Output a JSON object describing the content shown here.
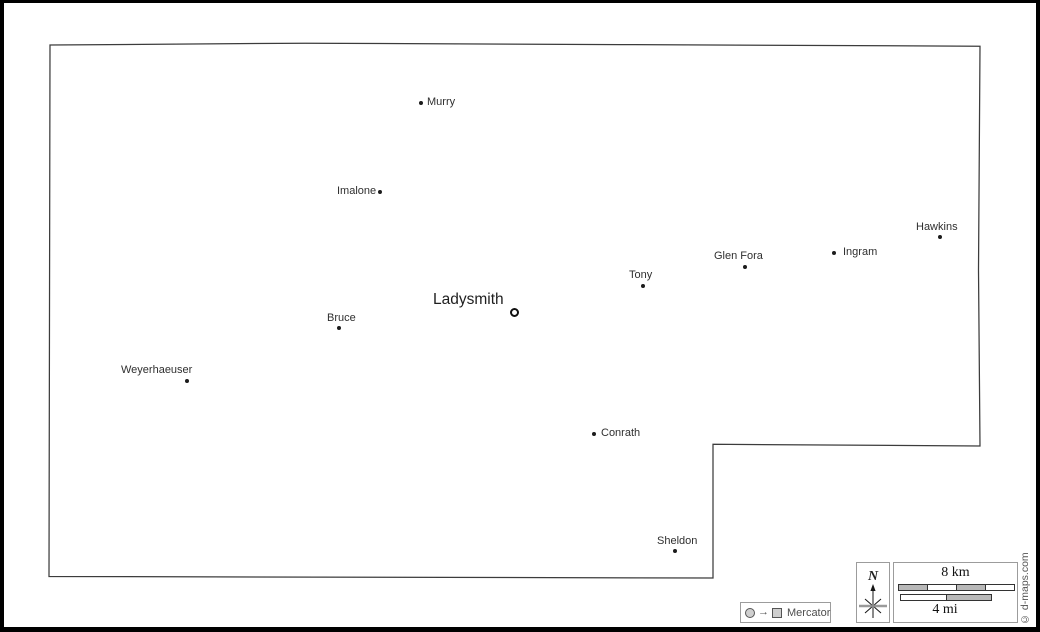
{
  "map": {
    "region_outline_name": "county-boundary",
    "outline_points_str": "50,45 305,43.2 620,44.6 980,46.2 978.5,270 980,446 713,444.3 713,578 49,576.5",
    "county_seat_name": "Ladysmith",
    "towns": [
      {
        "name": "Ladysmith",
        "marker": "ring",
        "dot": {
          "x": 514,
          "y": 312
        },
        "label": {
          "x": 433,
          "y": 291
        }
      },
      {
        "name": "Murry",
        "marker": "dot",
        "dot": {
          "x": 421,
          "y": 103
        },
        "label": {
          "x": 427,
          "y": 96
        }
      },
      {
        "name": "Imalone",
        "marker": "dot",
        "dot": {
          "x": 380,
          "y": 192
        },
        "label": {
          "x": 337,
          "y": 185
        }
      },
      {
        "name": "Hawkins",
        "marker": "dot",
        "dot": {
          "x": 940,
          "y": 237
        },
        "label": {
          "x": 916,
          "y": 221
        }
      },
      {
        "name": "Ingram",
        "marker": "dot",
        "dot": {
          "x": 834,
          "y": 253
        },
        "label": {
          "x": 843,
          "y": 246
        }
      },
      {
        "name": "Glen Fora",
        "marker": "dot",
        "dot": {
          "x": 745,
          "y": 267
        },
        "label": {
          "x": 714,
          "y": 250
        }
      },
      {
        "name": "Tony",
        "marker": "dot",
        "dot": {
          "x": 643,
          "y": 286
        },
        "label": {
          "x": 629,
          "y": 269
        }
      },
      {
        "name": "Bruce",
        "marker": "dot",
        "dot": {
          "x": 339,
          "y": 328
        },
        "label": {
          "x": 327,
          "y": 312
        }
      },
      {
        "name": "Weyerhaeuser",
        "marker": "dot",
        "dot": {
          "x": 187,
          "y": 381
        },
        "label": {
          "x": 121,
          "y": 364
        }
      },
      {
        "name": "Conrath",
        "marker": "dot",
        "dot": {
          "x": 594,
          "y": 434
        },
        "label": {
          "x": 601,
          "y": 427
        }
      },
      {
        "name": "Sheldon",
        "marker": "dot",
        "dot": {
          "x": 675,
          "y": 551
        },
        "label": {
          "x": 657,
          "y": 535
        }
      }
    ]
  },
  "projection": {
    "label": "Mercator",
    "arrow_glyph": "→"
  },
  "compass": {
    "north_label": "N"
  },
  "scale": {
    "km_label": "8 km",
    "mi_label": "4 mi"
  },
  "copyright": "© d-maps.com",
  "colors": {
    "outline": "#3c3c3c",
    "town_dot": "#1c1c1c",
    "town_label": "#2f2f2f",
    "frame": "#000000",
    "legend_border": "#9c9c9c",
    "scalebar_gray": "#b8b8b8",
    "legend_icon_gray": "#cfcfcf",
    "muted_text": "#555555"
  }
}
